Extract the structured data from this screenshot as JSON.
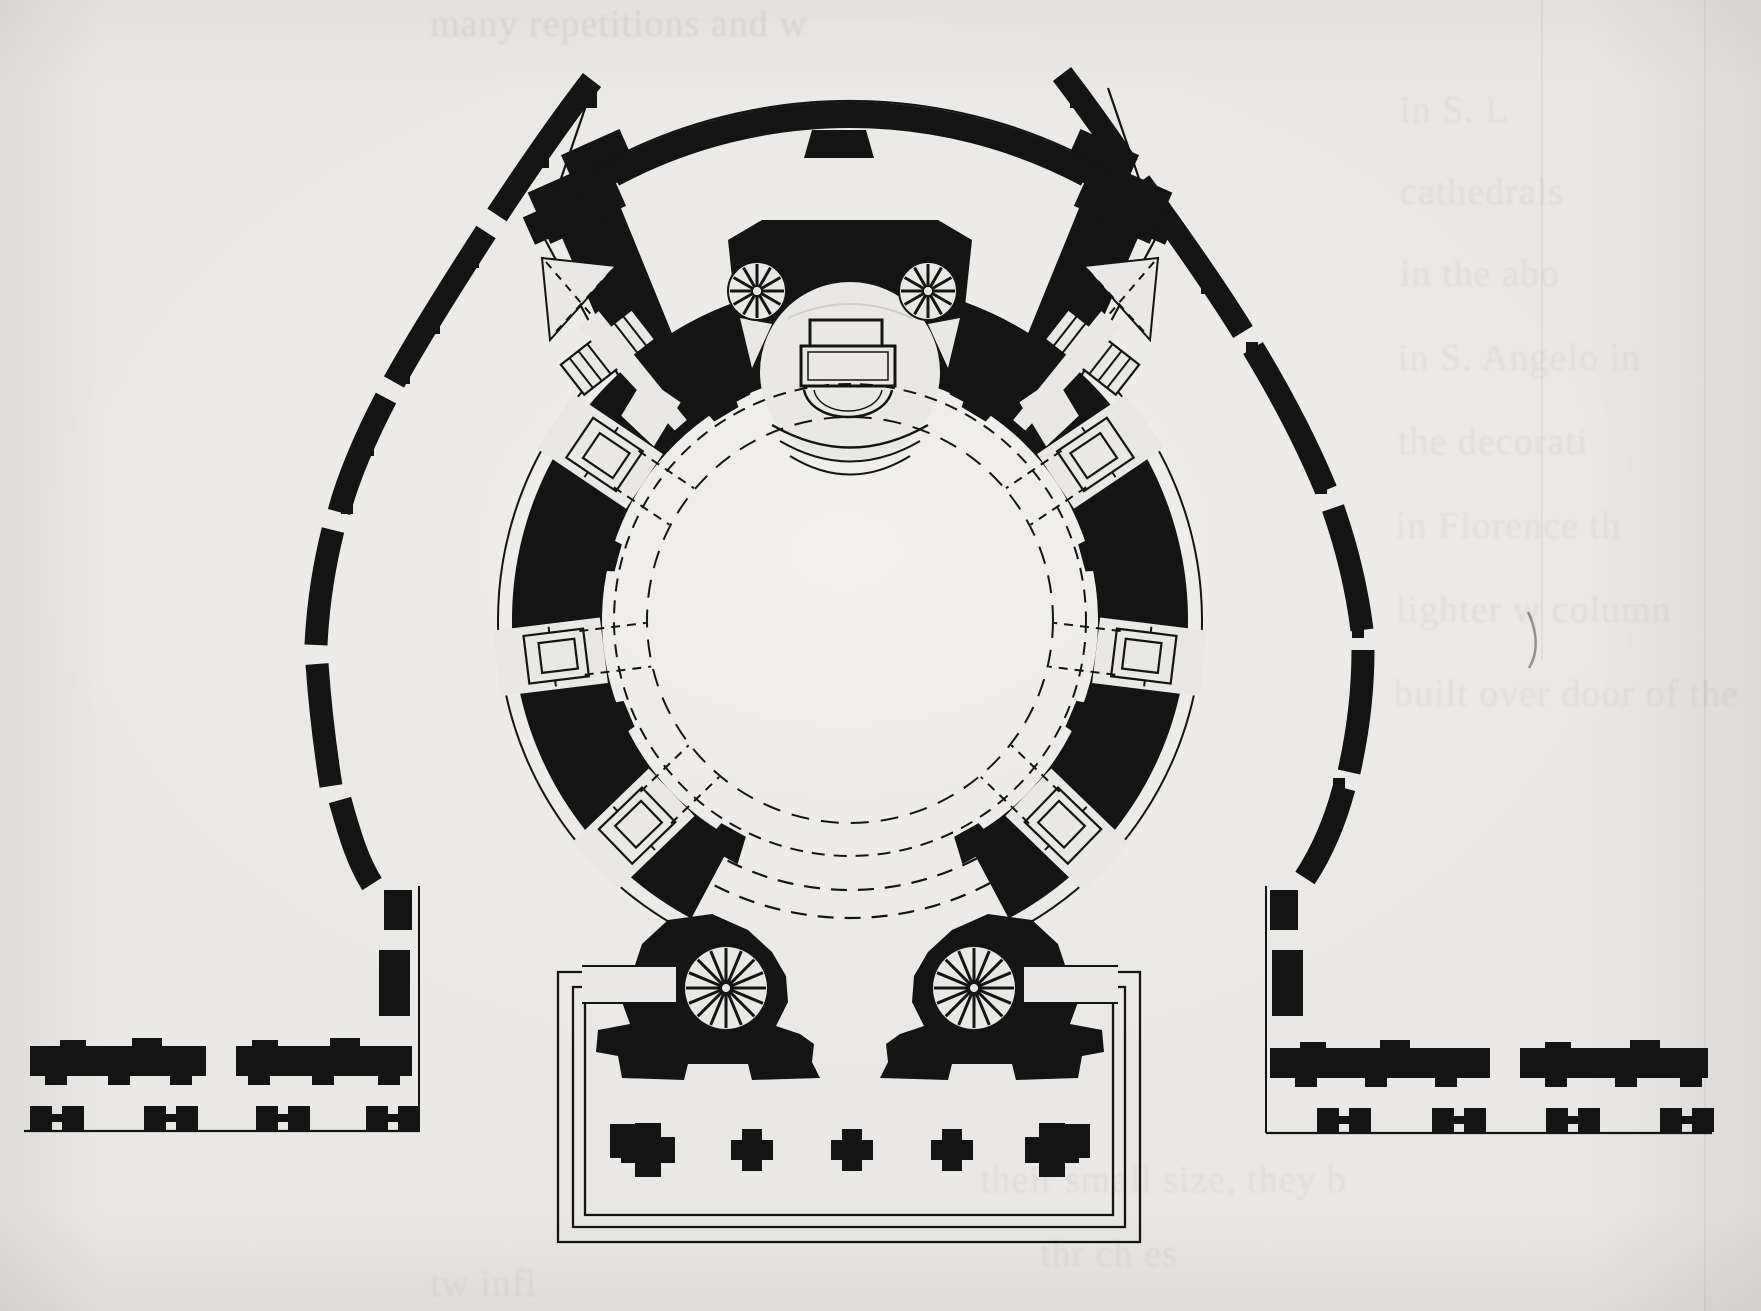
{
  "document": {
    "type": "scanned book page with architectural figure",
    "subject": "Ground plan of a circular domed church (rotunda) with an apse and baldachin altar at the top, six radiating rectangular chapels, four spiral staircases, two diagonal stair wings, a broken horseshoe-shaped outer colonnade precinct, flanking precinct walls with pier pairs, and a rectangular entrance forecourt with a row of cruciform piers",
    "paper_color": "#eae8e4",
    "ink_color": "#141414",
    "drawing_style": "black poché ink plan, hand drawn"
  },
  "plan": {
    "center": {
      "x": 850,
      "y": 620
    },
    "rotunda": {
      "outer_face_line_radius": 352,
      "wall_outer_radius": 338,
      "hall_radius": 248,
      "south_opening_half_angle_deg": 28
    },
    "dashed_circles_radii": [
      236,
      203
    ],
    "vestibule_dashed_arc_radii": [
      270,
      298
    ],
    "radial_chapels": {
      "count": 6,
      "bearings_deg": [
        -134,
        -97,
        -56,
        56,
        97,
        134
      ]
    },
    "wall_piers_bearings_deg": [
      -151,
      -113,
      -75,
      -31,
      31,
      75,
      113,
      151
    ],
    "apse_flank_piers_bearings_deg": [
      -28,
      28
    ],
    "apse": {
      "cx": 850,
      "cy": 372,
      "radius": 90
    },
    "altar": {
      "kind": "baldachin altar with back slab and curved bowl front"
    },
    "spiral_stairs": [
      {
        "cx": 757,
        "cy": 291,
        "r": 29,
        "spokes": 12
      },
      {
        "cx": 928,
        "cy": 291,
        "r": 29,
        "spokes": 12
      },
      {
        "cx": 726,
        "cy": 988,
        "r": 42,
        "spokes": 16
      },
      {
        "cx": 974,
        "cy": 988,
        "r": 42,
        "spokes": 16
      }
    ],
    "stair_flights": {
      "count": 2,
      "treads_per_flight": 7
    },
    "atrium": {
      "outer_rect": [
        558,
        972,
        1140,
        1242
      ],
      "border_line_insets": [
        0,
        15,
        27
      ],
      "pier_row_y": 1150,
      "pier_xs": [
        648,
        752,
        852,
        952,
        1052
      ]
    },
    "boundary_walls": {
      "left_baseline_y": 1131,
      "right_baseline_y": 1133,
      "left_dumbbell_pier_xs": [
        30,
        144,
        256,
        366
      ],
      "right_dumbbell_pier_xs": [
        1317,
        1432,
        1546,
        1660
      ]
    }
  },
  "ghost_text": {
    "note": "faint letterpress show-through from reverse of page, mostly illegible",
    "lines": [
      "many repetitions and w",
      "in S. L",
      "cathedrals",
      "in the abo",
      "in S. Angelo in",
      "the decorati",
      "in Florence th",
      "lighter w  column",
      "built over  door of the",
      "their small size, they b",
      "thr  ch  es",
      "tw  infl"
    ]
  }
}
